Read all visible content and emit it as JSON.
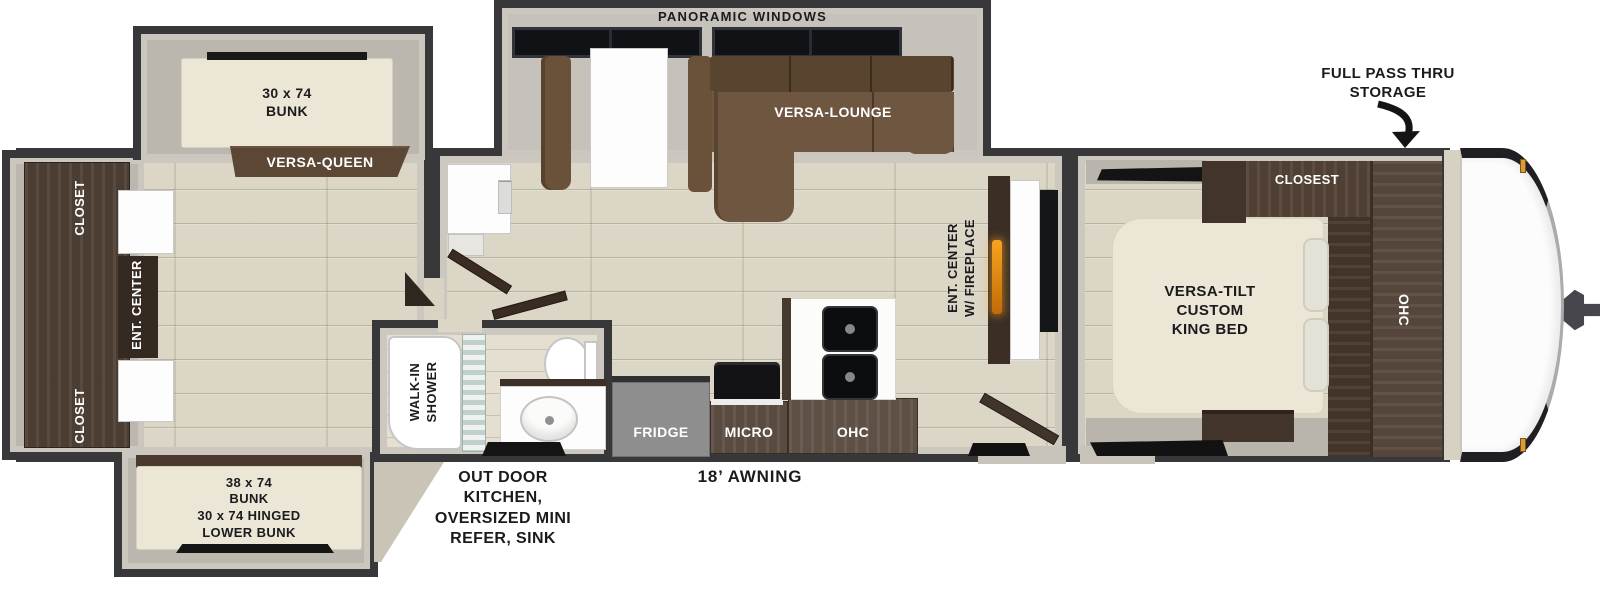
{
  "diagram_type": "travel trailer floorplan",
  "colors": {
    "wall": "#38383a",
    "wall_trim": "#ccc8c0",
    "wood_floor": "#dbd6c5",
    "slide_floor": "#bbb7af",
    "cabinet_dark": "#4c3d32",
    "sofa_brown": "#6f5640",
    "mattress_cream": "#ebe6d5",
    "fridge_gray": "#8e8e8e",
    "flame_orange": "#f6a41f",
    "mat_black": "#141414"
  },
  "exterior": {
    "panoramic_windows_label": "PANORAMIC WINDOWS",
    "pass_thru_label": "FULL PASS THRU\nSTORAGE",
    "awning_label": "18’ AWNING",
    "outdoor_kitchen_label": "OUT DOOR\nKITCHEN,\nOVERSIZED MINI\nREFER, SINK"
  },
  "bunk_room": {
    "upper_bunk_label": "30 x 74\nBUNK",
    "versa_queen_label": "VERSA-QUEEN",
    "closet_top_label": "CLOSET",
    "ent_center_label": "ENT. CENTER",
    "closet_bottom_label": "CLOSET",
    "lower_bunk_label": "38 x 74\nBUNK\n30 x 74 HINGED\nLOWER BUNK"
  },
  "living_area": {
    "lounge_label": "VERSA-LOUNGE",
    "fireplace_label": "ENT. CENTER\nW/ FIREPLACE",
    "fridge_label": "FRIDGE",
    "micro_label": "MICRO",
    "ohc_label": "OHC"
  },
  "bathroom": {
    "shower_label": "WALK-IN\nSHOWER"
  },
  "bedroom": {
    "bed_label": "VERSA-TILT\nCUSTOM\nKING BED",
    "closet_label": "CLOSEST",
    "ohc_label": "OHC"
  }
}
